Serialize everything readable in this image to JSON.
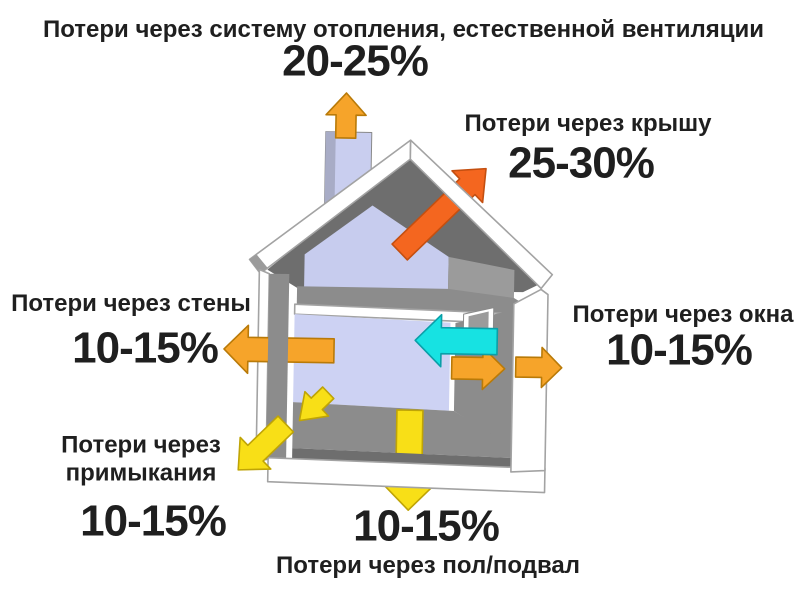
{
  "diagram": {
    "heating": {
      "label": "Потери через систему отопления, естественной вентиляции",
      "value": "20-25%"
    },
    "roof": {
      "label": "Потери через крышу",
      "value": "25-30%"
    },
    "walls": {
      "label": "Потери через стены",
      "value": "10-15%"
    },
    "windows": {
      "label": "Потери через окна",
      "value": "10-15%"
    },
    "junctions": {
      "label": "Потери через\nпримыкания",
      "value": "10-15%"
    },
    "floor": {
      "label": "Потери через пол/подвал",
      "value": "10-15%"
    }
  },
  "colors": {
    "background": "#FFFFFF",
    "text": "#1F1F1F",
    "arrow_orange": "#F6A42A",
    "arrow_red_orange": "#F4661F",
    "arrow_yellow": "#F8DF17",
    "arrow_cyan": "#17E2E2",
    "house_shell": "#FFFFFF",
    "house_outline": "#A3A3A3",
    "attic_wall_lavender": "#C7CCEE",
    "room_wall_lavender": "#CDD2F3",
    "chimney_lavender": "#C9CEEF",
    "chimney_side": "#A8ACC6",
    "gray_dark": "#6E6E6E",
    "gray_mid": "#8C8C8C",
    "gray_light": "#9B9B9B",
    "eave_cap_gray": "#9B9B9B",
    "window_pane_gray": "#9B9B9B"
  }
}
